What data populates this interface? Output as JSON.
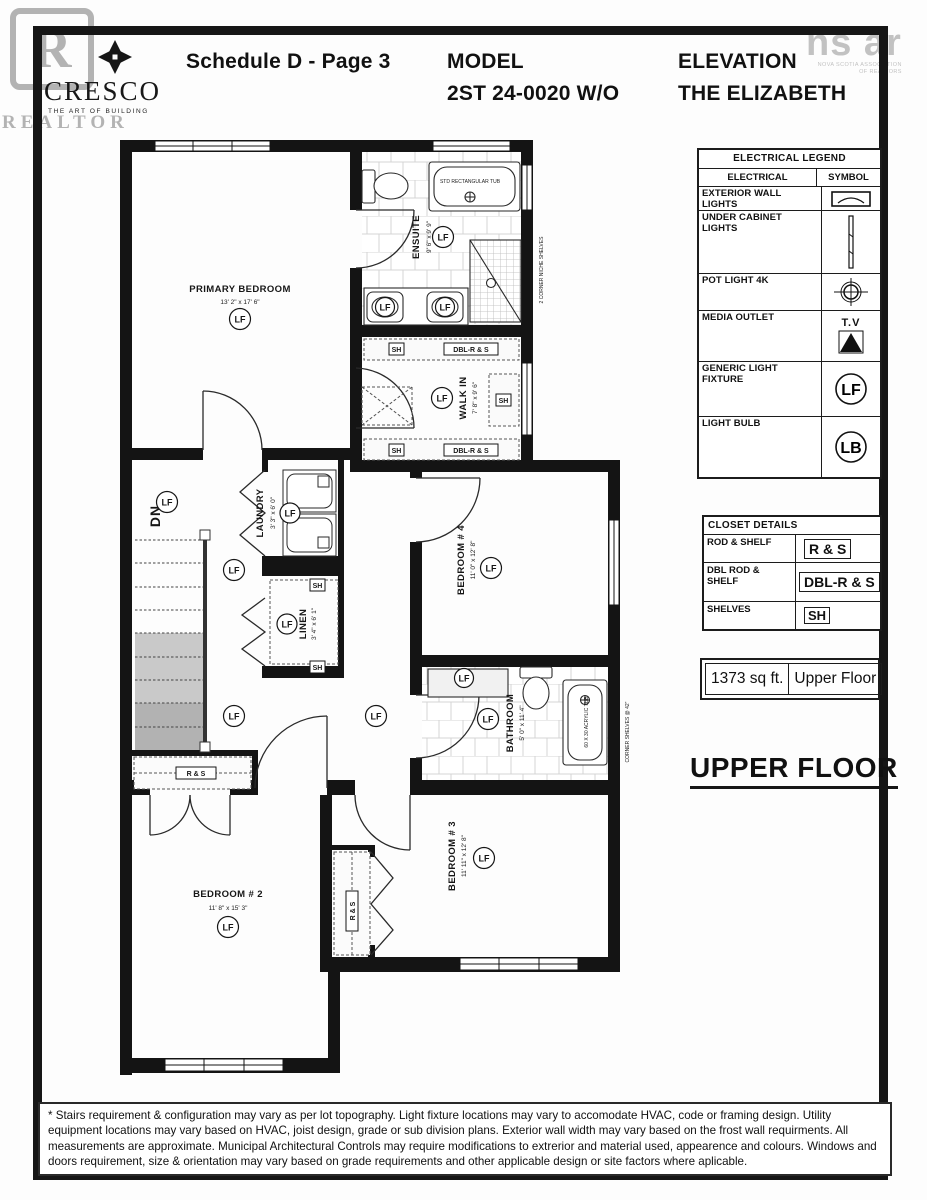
{
  "watermarks": {
    "realtor_letter": "R",
    "realtor_text": "REALTOR",
    "nsar_main": "ns ar",
    "nsar_sub1": "NOVA SCOTIA ASSOCIATION",
    "nsar_sub2": "OF REALTORS"
  },
  "header": {
    "logo_name": "CRESCO",
    "logo_tagline": "THE ART OF BUILDING",
    "schedule": "Schedule D - Page 3",
    "model_label": "MODEL",
    "model_value": "2ST 24-0020 W/O",
    "elevation_label": "ELEVATION",
    "elevation_value": "THE ELIZABETH"
  },
  "legend": {
    "title": "ELECTRICAL LEGEND",
    "col_electrical": "ELECTRICAL",
    "col_symbol": "SYMBOL",
    "rows": [
      {
        "label": "EXTERIOR WALL LIGHTS"
      },
      {
        "label": "UNDER CABINET LIGHTS"
      },
      {
        "label": "POT LIGHT 4K"
      },
      {
        "label": "MEDIA OUTLET",
        "sym": "T.V"
      },
      {
        "label": "GENERIC LIGHT FIXTURE",
        "sym": "LF"
      },
      {
        "label": "LIGHT BULB",
        "sym": "LB"
      }
    ]
  },
  "closet": {
    "title": "CLOSET DETAILS",
    "rows": [
      {
        "label": "ROD & SHELF",
        "tag": "R & S"
      },
      {
        "label": "DBL ROD & SHELF",
        "tag": "DBL-R & S"
      },
      {
        "label": "SHELVES",
        "tag": "SH"
      }
    ]
  },
  "area": {
    "sqft": "1373 sq ft.",
    "floor": "Upper Floor"
  },
  "floor_title": "UPPER FLOOR",
  "plan": {
    "rooms": {
      "primary": {
        "name": "PRIMARY BEDROOM",
        "dims": "13' 2\" x 17' 6\""
      },
      "ensuite": {
        "name": "ENSUITE",
        "dims": "9' 6\" x 9' 9\""
      },
      "walkin": {
        "name": "WALK IN",
        "dims": "7' 8\" x 9' 6\""
      },
      "laundry": {
        "name": "LAUNDRY",
        "dims": "3' 3\" x 6' 0\""
      },
      "linen": {
        "name": "LINEN",
        "dims": "3' 4\" x 6' 1\""
      },
      "bedroom4": {
        "name": "BEDROOM # 4",
        "dims": "11' 0\" x 12' 8\""
      },
      "bathroom": {
        "name": "BATHROOM",
        "dims": "5' 0\" x 11' 4\""
      },
      "bedroom3": {
        "name": "BEDROOM # 3",
        "dims": "11' 11\" x 12' 8\""
      },
      "bedroom2": {
        "name": "BEDROOM # 2",
        "dims": "11' 8\" x 15' 3\""
      }
    },
    "labels": {
      "lf": "LF",
      "sh": "SH",
      "rs": "R & S",
      "dblrs": "DBL-R & S",
      "dn": "DN",
      "tub_std": "STD RECTANGULAR TUB",
      "tub_main": "60 X 30 ACRYLIC TUB",
      "niche": "2 CORNER NICHE SHELVES",
      "corner42": "CORNER SHELVES @ 42\""
    }
  },
  "footer": "* Stairs requirement & configuration may vary as per lot topography. Light fixture locations may vary to accomodate HVAC, code or framing design. Utility equipment locations may vary based on HVAC, joist design, grade or sub division plans. Exterior wall width may vary based on the frost wall requirments. All measurements are approximate. Municipal Architectural Controls may require modifications to extrerior and material used, appearence and colours. Windows and doors requirement, size & orientation may vary based on grade requirements and other applicable design or site factors where aplicable."
}
